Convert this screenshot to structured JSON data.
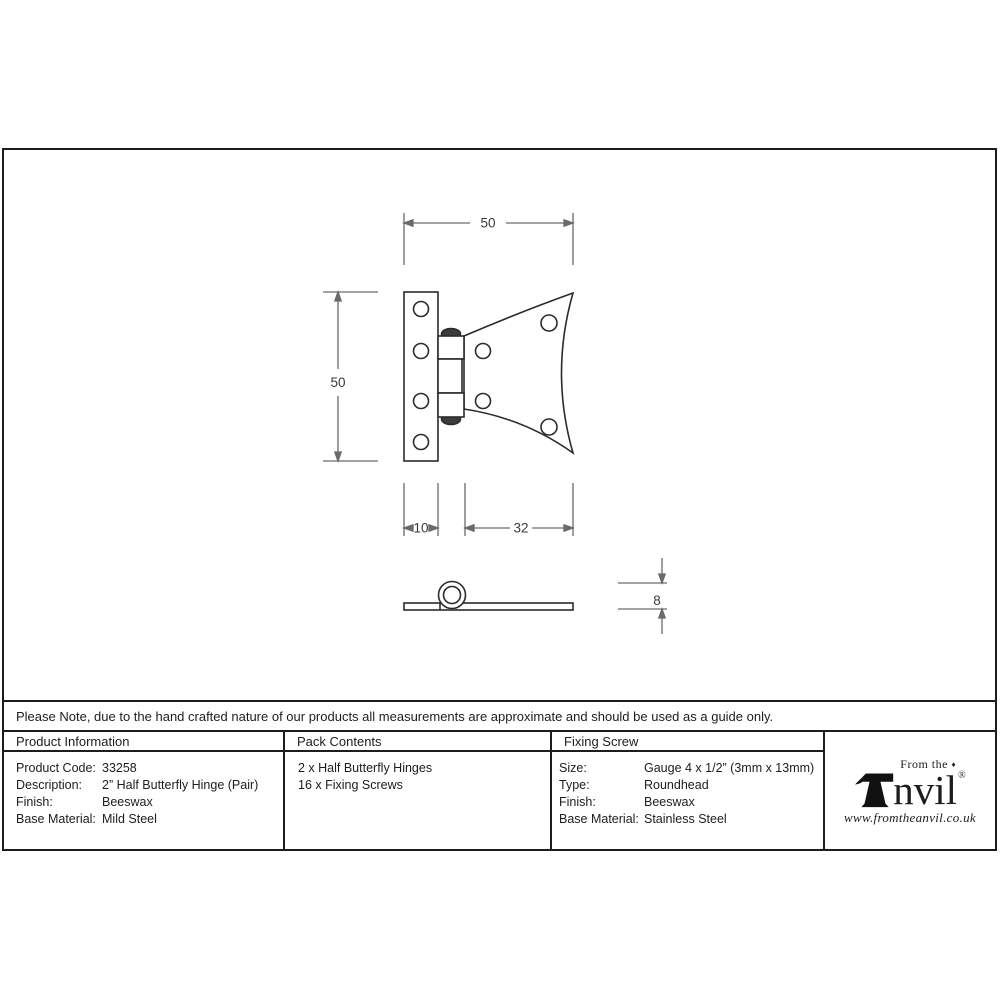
{
  "drawing": {
    "dim_top_width": "50",
    "dim_left_height": "50",
    "dim_leaf_width": "10",
    "dim_wing_width": "32",
    "dim_thickness": "8"
  },
  "note": "Please Note, due to the hand crafted nature of our products all measurements are approximate and should be used as a guide only.",
  "table": {
    "product_info": {
      "header": "Product Information",
      "rows": [
        {
          "label": "Product Code:",
          "value": "33258"
        },
        {
          "label": "Description:",
          "value": "2” Half Butterfly Hinge (Pair)"
        },
        {
          "label": "Finish:",
          "value": "Beeswax"
        },
        {
          "label": "Base Material:",
          "value": "Mild Steel"
        }
      ]
    },
    "pack_contents": {
      "header": "Pack Contents",
      "items": [
        "2 x Half Butterfly Hinges",
        "16 x Fixing Screws"
      ]
    },
    "fixing_screw": {
      "header": "Fixing Screw",
      "rows": [
        {
          "label": "Size:",
          "value": "Gauge 4 x 1/2” (3mm x 13mm)"
        },
        {
          "label": "Type:",
          "value": "Roundhead"
        },
        {
          "label": "Finish:",
          "value": "Beeswax"
        },
        {
          "label": "Base Material:",
          "value": "Stainless Steel"
        }
      ]
    }
  },
  "logo": {
    "prefix": "From the",
    "diamond": "♦",
    "name_suffix": "nvil",
    "registered": "®",
    "url": "www.fromtheanvil.co.uk"
  },
  "colors": {
    "ink": "#1d1d1d",
    "part_outline": "#2b2b2b",
    "dimension_line": "#6a6a6a"
  }
}
